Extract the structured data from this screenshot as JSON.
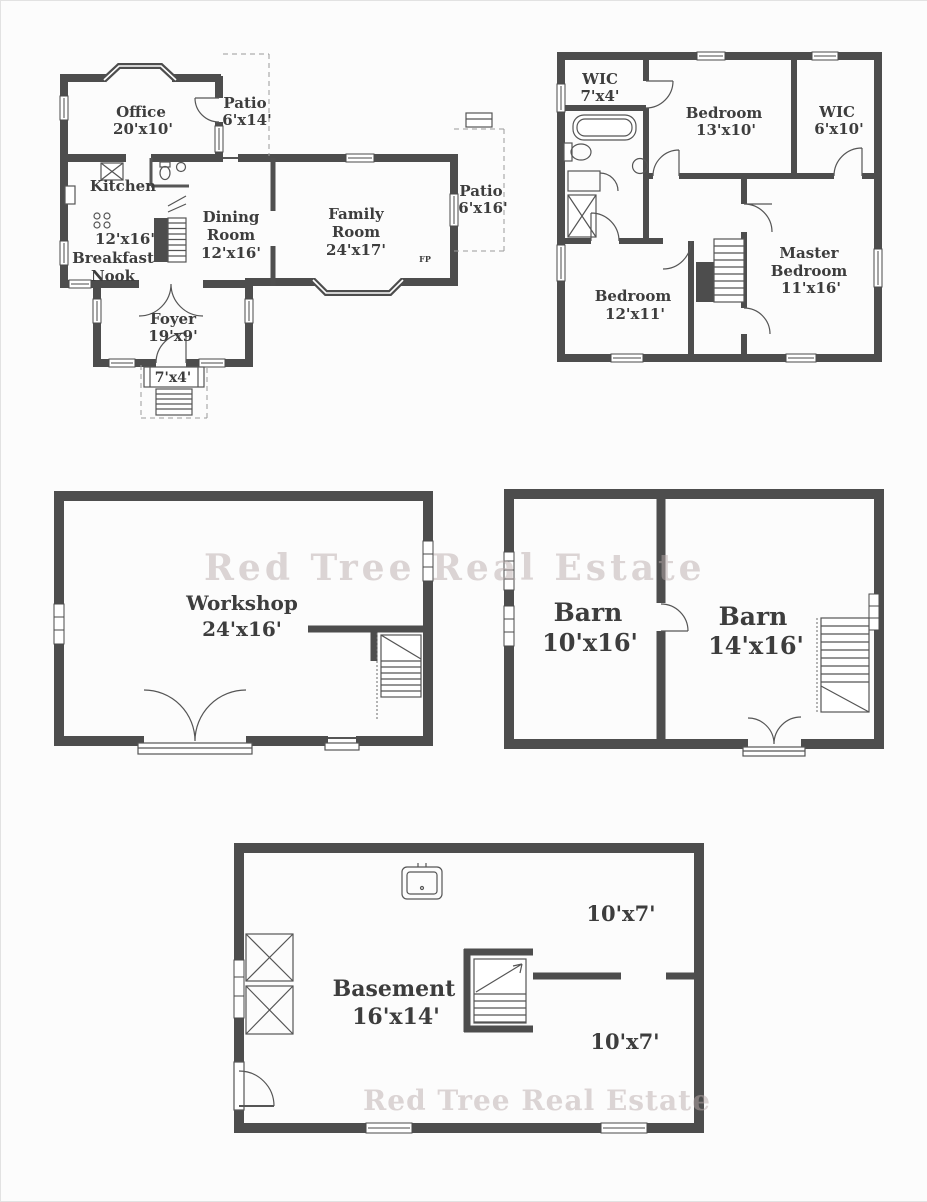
{
  "document": {
    "colors": {
      "wall": "#4d4d4d",
      "label": "#3d3d3d",
      "watermark": "#beacac"
    },
    "watermark": {
      "middle": "Red Tree Real Estate",
      "bottom": "Red Tree Real Estate"
    },
    "first_floor": {
      "office": {
        "name": "Office",
        "dims": "20'x10'"
      },
      "patio_upper": {
        "name": "Patio",
        "dims": "6'x14'"
      },
      "kitchen": {
        "name": "Kitchen",
        "dims": "12'x16'"
      },
      "breakfast_nook": {
        "line1": "Breakfast",
        "line2": "Nook"
      },
      "dining_room": {
        "line1": "Dining",
        "line2": "Room",
        "dims": "12'x16'"
      },
      "family_room": {
        "line1": "Family",
        "line2": "Room",
        "dims": "24'x17'"
      },
      "patio_right": {
        "name": "Patio",
        "dims": "6'x16'"
      },
      "foyer": {
        "name": "Foyer",
        "dims": "19'x9'"
      },
      "stoop": {
        "dims": "7'x4'"
      },
      "fireplace": "FP"
    },
    "second_floor": {
      "wic_small": {
        "name": "WIC",
        "dims": "7'x4'"
      },
      "bedroom_13": {
        "name": "Bedroom",
        "dims": "13'x10'"
      },
      "wic_right": {
        "name": "WIC",
        "dims": "6'x10'"
      },
      "bedroom_12": {
        "name": "Bedroom",
        "dims": "12'x11'"
      },
      "master_bedroom": {
        "line1": "Master",
        "line2": "Bedroom",
        "dims": "11'x16'"
      }
    },
    "workshop": {
      "name": "Workshop",
      "dims": "24'x16'"
    },
    "barn": {
      "left": {
        "name": "Barn",
        "dims": "10'x16'"
      },
      "right": {
        "name": "Barn",
        "dims": "14'x16'"
      }
    },
    "basement": {
      "main": {
        "name": "Basement",
        "dims": "16'x14'"
      },
      "room_top": {
        "dims": "10'x7'"
      },
      "room_bottom": {
        "dims": "10'x7'"
      }
    }
  }
}
